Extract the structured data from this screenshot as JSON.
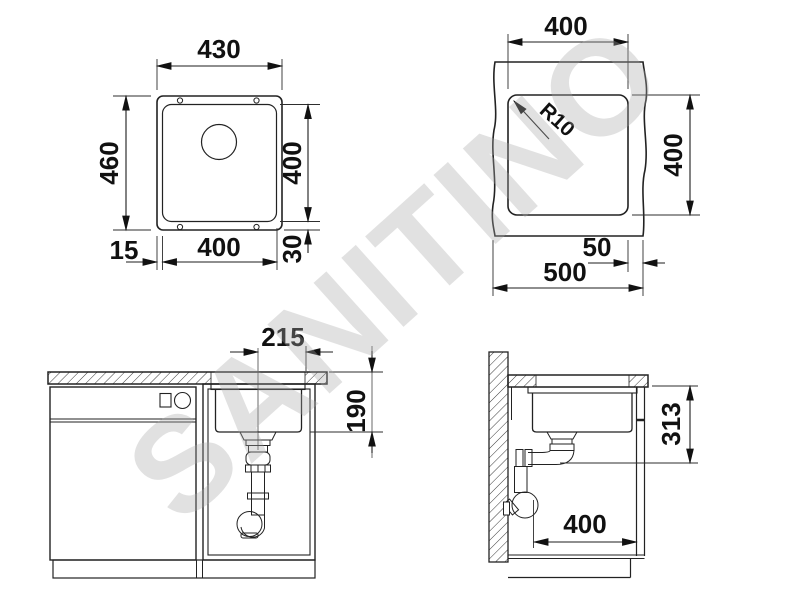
{
  "watermark": {
    "text": "SANITINO"
  },
  "drawings": {
    "top_view": {
      "overall_width": "430",
      "overall_depth": "460",
      "bowl_width": "400",
      "bowl_depth": "400",
      "edge_left": "15",
      "edge_bottom": "30"
    },
    "cutout_view": {
      "cutout_width": "400",
      "cutout_depth": "400",
      "corner_radius": "R10",
      "edge_distance": "50",
      "cabinet_width": "500"
    },
    "front_view": {
      "drain_offset": "215",
      "bowl_height": "190"
    },
    "side_view": {
      "mount_depth": "313",
      "base_depth": "400"
    }
  }
}
